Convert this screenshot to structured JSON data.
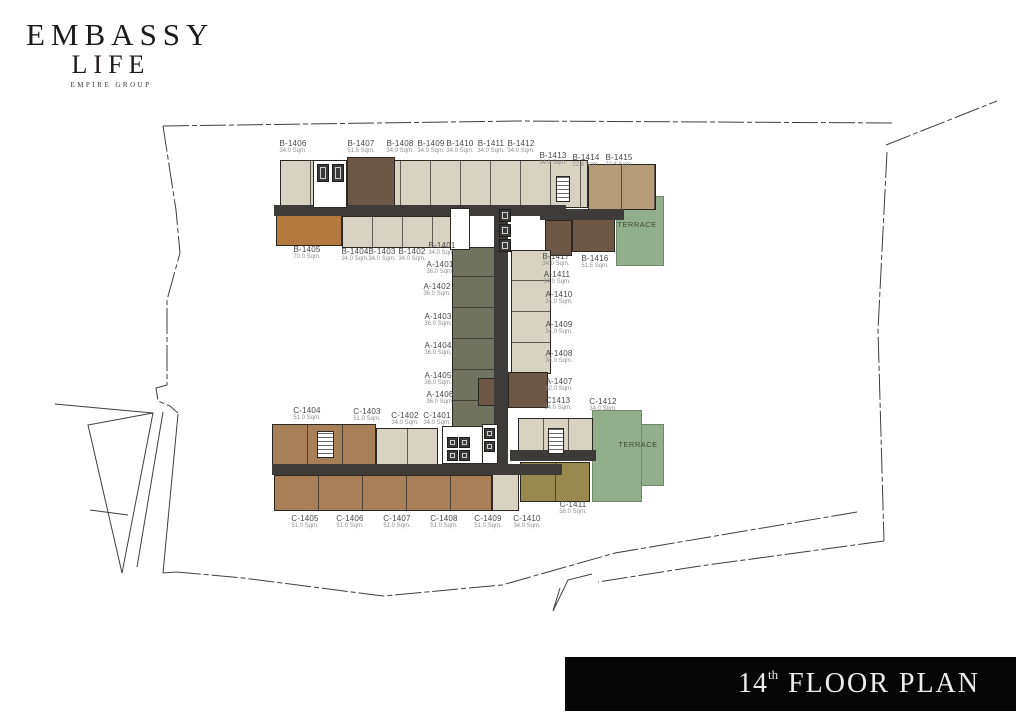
{
  "logo": {
    "line1": "EMBASSY",
    "line2": "LIFE",
    "line3": "EMPIRE GROUP"
  },
  "banner": {
    "floor": "14",
    "suffix": "th",
    "text": "FLOOR PLAN"
  },
  "floorplan": {
    "palette": {
      "cream": "#d7d2c2",
      "brown_dark": "#6d5848",
      "orange": "#b3793f",
      "tan": "#b49d78",
      "brown_mid": "#a97f57",
      "olive": "#98894f",
      "green": "#93ae8c",
      "grey_green": "#70735f",
      "corridor": "#3d3c3a",
      "white": "#ffffff"
    },
    "blocks": [
      {
        "name": "terrace-north",
        "fill": "green",
        "cls": "terrace",
        "x": 616,
        "y": 196,
        "w": 48,
        "h": 70
      },
      {
        "name": "terrace-south",
        "fill": "green",
        "cls": "terrace",
        "x": 592,
        "y": 410,
        "w": 50,
        "h": 92
      },
      {
        "name": "terrace-south-step",
        "fill": "green",
        "cls": "terrace",
        "x": 641,
        "y": 424,
        "w": 23,
        "h": 62
      },
      {
        "name": "north-wing-upper-units",
        "fill": "cream",
        "x": 280,
        "y": 160,
        "w": 308,
        "h": 48,
        "div": 30
      },
      {
        "name": "unit-B-1407",
        "fill": "brown_dark",
        "x": 347,
        "y": 157,
        "w": 48,
        "h": 51
      },
      {
        "name": "units-B-1414-B-1415",
        "fill": "tan",
        "x": 588,
        "y": 164,
        "w": 68,
        "h": 46,
        "div": 33
      },
      {
        "name": "unit-B-1405",
        "fill": "orange",
        "x": 276,
        "y": 214,
        "w": 66,
        "h": 32
      },
      {
        "name": "north-wing-lower-units",
        "fill": "cream",
        "x": 342,
        "y": 216,
        "w": 122,
        "h": 32,
        "div": 30
      },
      {
        "name": "unit-B-1417",
        "fill": "brown_dark",
        "x": 545,
        "y": 220,
        "w": 27,
        "h": 36
      },
      {
        "name": "unit-B-1416",
        "fill": "brown_dark",
        "x": 572,
        "y": 213,
        "w": 43,
        "h": 39
      },
      {
        "name": "a-units-west-column",
        "fill": "grey_green",
        "x": 452,
        "y": 247,
        "w": 46,
        "h": 185,
        "div": 31,
        "axis": "h"
      },
      {
        "name": "a-units-east-column",
        "fill": "cream",
        "x": 511,
        "y": 250,
        "w": 40,
        "h": 124,
        "div": 31,
        "axis": "h"
      },
      {
        "name": "unit-A-1407-east",
        "fill": "brown_dark",
        "x": 508,
        "y": 372,
        "w": 40,
        "h": 36
      },
      {
        "name": "unit-A-1407-west",
        "fill": "brown_dark",
        "x": 478,
        "y": 378,
        "w": 18,
        "h": 28
      },
      {
        "name": "south-wing-upper-brown-units",
        "fill": "brown_mid",
        "x": 272,
        "y": 424,
        "w": 104,
        "h": 42,
        "div": 35
      },
      {
        "name": "south-wing-upper-cream-units",
        "fill": "cream",
        "x": 376,
        "y": 428,
        "w": 62,
        "h": 38,
        "div": 31
      },
      {
        "name": "south-wing-east-units",
        "fill": "cream",
        "x": 518,
        "y": 418,
        "w": 75,
        "h": 42,
        "div": 25
      },
      {
        "name": "south-wing-lower-units",
        "fill": "brown_mid",
        "x": 274,
        "y": 475,
        "w": 218,
        "h": 36,
        "div": 44
      },
      {
        "name": "unit-C-1410",
        "fill": "cream",
        "x": 492,
        "y": 473,
        "w": 27,
        "h": 38
      },
      {
        "name": "unit-C-1411",
        "fill": "olive",
        "x": 520,
        "y": 462,
        "w": 70,
        "h": 40,
        "div": 35
      },
      {
        "name": "corridor-north",
        "fill": "corridor",
        "cls": "corridor",
        "x": 274,
        "y": 205,
        "w": 292,
        "h": 11
      },
      {
        "name": "corridor-north-east",
        "fill": "corridor",
        "cls": "corridor",
        "x": 540,
        "y": 209,
        "w": 84,
        "h": 11
      },
      {
        "name": "corridor-central",
        "fill": "corridor",
        "cls": "corridor",
        "x": 494,
        "y": 205,
        "w": 14,
        "h": 262
      },
      {
        "name": "corridor-south",
        "fill": "corridor",
        "cls": "corridor",
        "x": 272,
        "y": 464,
        "w": 290,
        "h": 11
      },
      {
        "name": "corridor-south-east",
        "fill": "corridor",
        "cls": "corridor",
        "x": 510,
        "y": 450,
        "w": 86,
        "h": 11
      }
    ],
    "cores": [
      {
        "name": "north-lift-core",
        "x": 313,
        "y": 160,
        "w": 34,
        "h": 48,
        "stairs": false
      },
      {
        "name": "north-east-stair-core",
        "x": 556,
        "y": 176,
        "w": 14,
        "h": 26,
        "stairs": true
      },
      {
        "name": "central-core",
        "x": 450,
        "y": 208,
        "w": 20,
        "h": 42,
        "stairs": false
      },
      {
        "name": "south-west-stair-core",
        "x": 317,
        "y": 431,
        "w": 17,
        "h": 27,
        "stairs": true
      },
      {
        "name": "south-east-stair-core",
        "x": 548,
        "y": 428,
        "w": 16,
        "h": 26,
        "stairs": true
      },
      {
        "name": "south-lift-core",
        "x": 442,
        "y": 426,
        "w": 52,
        "h": 38,
        "stairs": false
      },
      {
        "name": "south-lift-core-east",
        "x": 482,
        "y": 424,
        "w": 16,
        "h": 40,
        "stairs": false
      }
    ],
    "lifts": [
      {
        "x": 317,
        "y": 164,
        "w": 12,
        "h": 18
      },
      {
        "x": 332,
        "y": 164,
        "w": 12,
        "h": 18
      },
      {
        "x": 499,
        "y": 209,
        "w": 12,
        "h": 13
      },
      {
        "x": 499,
        "y": 224,
        "w": 12,
        "h": 13
      },
      {
        "x": 499,
        "y": 239,
        "w": 12,
        "h": 13
      },
      {
        "x": 447,
        "y": 437,
        "w": 11,
        "h": 11
      },
      {
        "x": 459,
        "y": 437,
        "w": 11,
        "h": 11
      },
      {
        "x": 447,
        "y": 450,
        "w": 11,
        "h": 11
      },
      {
        "x": 459,
        "y": 450,
        "w": 11,
        "h": 11
      },
      {
        "x": 484,
        "y": 428,
        "w": 11,
        "h": 11
      },
      {
        "x": 484,
        "y": 441,
        "w": 11,
        "h": 11
      }
    ],
    "unit_labels": [
      {
        "name": "B-1406",
        "area": "34.0 Sqm.",
        "x": 293,
        "y": 139
      },
      {
        "name": "B-1407",
        "area": "51.5 Sqm.",
        "x": 361,
        "y": 139
      },
      {
        "name": "B-1408",
        "area": "34.0 Sqm.",
        "x": 400,
        "y": 139
      },
      {
        "name": "B-1409",
        "area": "34.0 Sqm.",
        "x": 431,
        "y": 139
      },
      {
        "name": "B-1410",
        "area": "34.0 Sqm.",
        "x": 460,
        "y": 139
      },
      {
        "name": "B-1411",
        "area": "34.0 Sqm.",
        "x": 491,
        "y": 139
      },
      {
        "name": "B-1412",
        "area": "34.0 Sqm.",
        "x": 521,
        "y": 139
      },
      {
        "name": "B-1413",
        "area": "34.0 Sqm.",
        "x": 553,
        "y": 151
      },
      {
        "name": "B-1414",
        "area": "22.6 Sqm.",
        "x": 586,
        "y": 153
      },
      {
        "name": "B-1415",
        "area": "22.6 Sqm.",
        "x": 619,
        "y": 153
      },
      {
        "name": "B-1405",
        "area": "70.0 Sqm.",
        "x": 307,
        "y": 245
      },
      {
        "name": "B-1404",
        "area": "34.0 Sqm.",
        "x": 355,
        "y": 247
      },
      {
        "name": "B-1403",
        "area": "34.0 Sqm.",
        "x": 382,
        "y": 247
      },
      {
        "name": "B-1402",
        "area": "34.0 Sqm.",
        "x": 412,
        "y": 247
      },
      {
        "name": "B-1401",
        "area": "34.0 Sqm.",
        "x": 442,
        "y": 241
      },
      {
        "name": "A-1401",
        "area": "36.0 Sqm.",
        "x": 440,
        "y": 260
      },
      {
        "name": "A-1402",
        "area": "36.0 Sqm.",
        "x": 437,
        "y": 282
      },
      {
        "name": "A-1403",
        "area": "36.0 Sqm.",
        "x": 438,
        "y": 312
      },
      {
        "name": "A-1404",
        "area": "36.0 Sqm.",
        "x": 438,
        "y": 341
      },
      {
        "name": "A-1405",
        "area": "36.0 Sqm.",
        "x": 438,
        "y": 371
      },
      {
        "name": "A-1406",
        "area": "36.0 Sqm.",
        "x": 440,
        "y": 390
      },
      {
        "name": "B-1417",
        "area": "34.0 Sqm.",
        "x": 556,
        "y": 252
      },
      {
        "name": "B-1416",
        "area": "51.5 Sqm.",
        "x": 595,
        "y": 254
      },
      {
        "name": "A-1411",
        "area": "34.0 Sqm.",
        "x": 557,
        "y": 270
      },
      {
        "name": "A-1410",
        "area": "34.0 Sqm.",
        "x": 559,
        "y": 290
      },
      {
        "name": "A-1409",
        "area": "34.0 Sqm.",
        "x": 559,
        "y": 320
      },
      {
        "name": "A-1408",
        "area": "34.0 Sqm.",
        "x": 559,
        "y": 349
      },
      {
        "name": "A-1407",
        "area": "52.0 Sqm.",
        "x": 559,
        "y": 377
      },
      {
        "name": "C1413",
        "area": "34.0 Sqm.",
        "x": 558,
        "y": 396
      },
      {
        "name": "C-1412",
        "area": "34.0 Sqm.",
        "x": 603,
        "y": 397
      },
      {
        "name": "C-1404",
        "area": "51.0 Sqm.",
        "x": 307,
        "y": 406
      },
      {
        "name": "C-1403",
        "area": "51.0 Sqm.",
        "x": 367,
        "y": 407
      },
      {
        "name": "C-1402",
        "area": "34.0 Sqm.",
        "x": 405,
        "y": 411
      },
      {
        "name": "C-1401",
        "area": "34.0 Sqm.",
        "x": 437,
        "y": 411
      },
      {
        "name": "C-1405",
        "area": "51.0 Sqm.",
        "x": 305,
        "y": 514
      },
      {
        "name": "C-1406",
        "area": "51.0 Sqm.",
        "x": 350,
        "y": 514
      },
      {
        "name": "C-1407",
        "area": "51.0 Sqm.",
        "x": 397,
        "y": 514
      },
      {
        "name": "C-1408",
        "area": "51.0 Sqm.",
        "x": 444,
        "y": 514
      },
      {
        "name": "C-1409",
        "area": "51.0 Sqm.",
        "x": 488,
        "y": 514
      },
      {
        "name": "C-1410",
        "area": "34.0 Sqm.",
        "x": 527,
        "y": 514
      },
      {
        "name": "C-1411",
        "area": "58.0 Sqm.",
        "x": 573,
        "y": 500
      }
    ],
    "terrace_labels": [
      {
        "text": "TERRACE",
        "x": 637,
        "y": 220
      },
      {
        "text": "TERRACE",
        "x": 638,
        "y": 440
      }
    ],
    "boundary": [
      {
        "d": "M163,126 L520,121 L893,123",
        "dash": true
      },
      {
        "d": "M886,145 L997,101",
        "dash": true
      },
      {
        "d": "M887,152 L878,330 L884,541",
        "dash": true
      },
      {
        "d": "M884,541 L700,566 L598,582",
        "dash": true
      },
      {
        "d": "M592,574 L568,580 L553,611 L560,588",
        "dash": false
      },
      {
        "d": "M857,512 L615,553 L502,585 L383,596 L243,578 L177,572",
        "dash": true
      },
      {
        "d": "M163,126 L176,210 L180,253 L167,300 L167,385 L156,388 L158,401 L170,406 L178,413",
        "dash": true
      },
      {
        "d": "M163,412 L137,567",
        "dash": false
      },
      {
        "d": "M178,414 L163,573 L177,572",
        "dash": false
      },
      {
        "d": "M88,425 L153,413 L122,573 Z",
        "dash": false
      },
      {
        "d": "M90,510 L128,515",
        "dash": false
      },
      {
        "d": "M55,404 L153,413",
        "dash": false
      }
    ]
  }
}
